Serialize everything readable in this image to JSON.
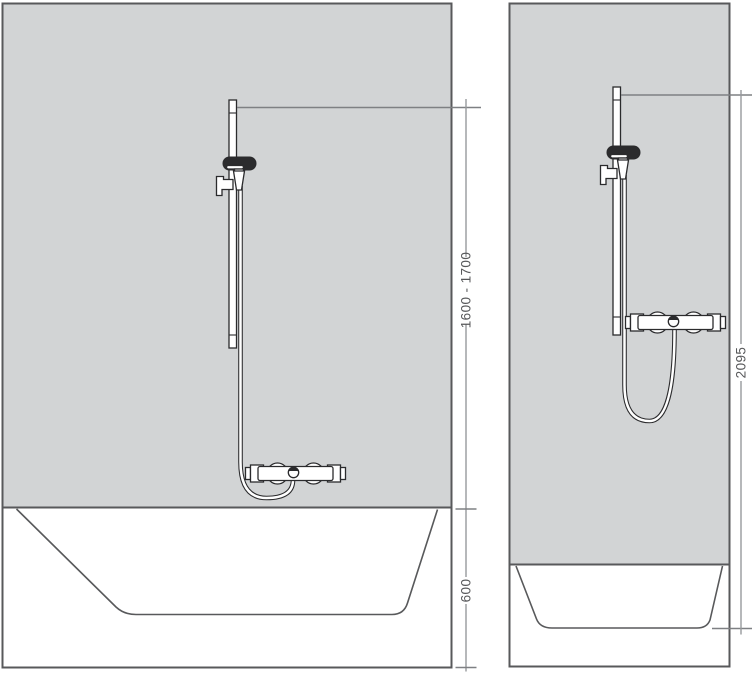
{
  "colors": {
    "background": "#ffffff",
    "wall_fill": "#d2d4d5",
    "panel_outline": "#58595b",
    "fixture_line": "#2b2b2d",
    "fixture_dark_fill": "#2b2b2d",
    "dimension_line": "#97999c",
    "leader_line": "#7e8083",
    "dimension_text": "#58595b"
  },
  "left_diagram": {
    "dim_bar_height_range": "1600 - 1700",
    "dim_basin_height": "600"
  },
  "right_diagram": {
    "dim_total_height": "2095"
  }
}
